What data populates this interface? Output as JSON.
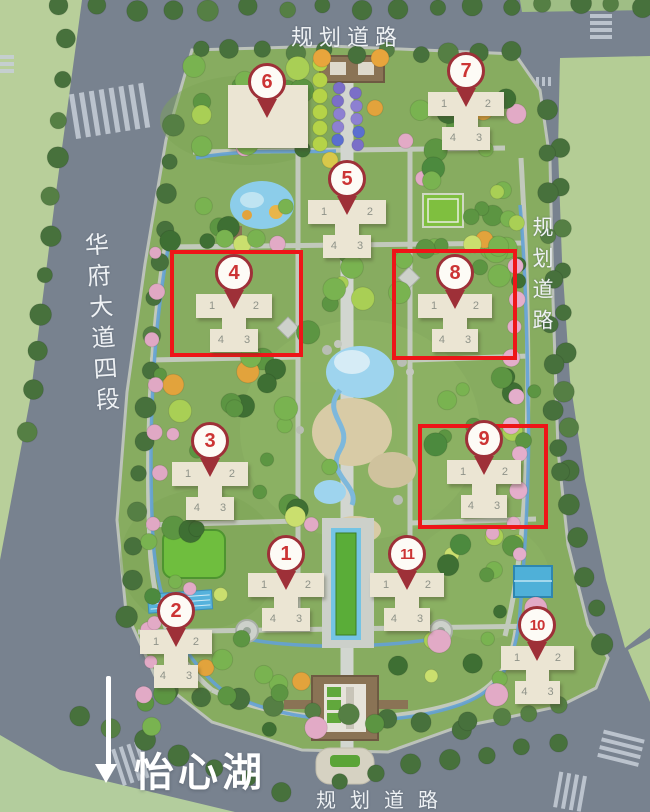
{
  "map": {
    "road_labels": {
      "top": "规划道路",
      "right": "规划道路",
      "bottom": "规划道路",
      "left": "华府大道四段"
    },
    "lake_label": "怡心湖",
    "buildings": [
      {
        "id": "1",
        "pin_label": "1",
        "type": "cross",
        "x": 248,
        "y": 573,
        "w": 76,
        "units": [
          "1",
          "2",
          "4",
          "3"
        ],
        "pin_x": 286,
        "pin_y": 589,
        "highlighted": false
      },
      {
        "id": "2",
        "pin_label": "2",
        "type": "cross",
        "x": 140,
        "y": 630,
        "w": 72,
        "units": [
          "1",
          "2",
          "4",
          "3"
        ],
        "pin_x": 176,
        "pin_y": 646,
        "highlighted": false
      },
      {
        "id": "3",
        "pin_label": "3",
        "type": "cross",
        "x": 172,
        "y": 462,
        "w": 76,
        "units": [
          "1",
          "2",
          "4",
          "3"
        ],
        "pin_x": 210,
        "pin_y": 476,
        "highlighted": false
      },
      {
        "id": "4",
        "pin_label": "4",
        "type": "cross",
        "x": 196,
        "y": 294,
        "w": 76,
        "units": [
          "1",
          "2",
          "4",
          "3"
        ],
        "pin_x": 234,
        "pin_y": 308,
        "highlighted": true
      },
      {
        "id": "5",
        "pin_label": "5",
        "type": "cross",
        "x": 308,
        "y": 200,
        "w": 78,
        "units": [
          "1",
          "2",
          "4",
          "3"
        ],
        "pin_x": 347,
        "pin_y": 214,
        "highlighted": false
      },
      {
        "id": "6",
        "pin_label": "6",
        "type": "block",
        "x": 228,
        "y": 85,
        "w": 80,
        "h": 63,
        "units": [],
        "pin_x": 267,
        "pin_y": 117,
        "highlighted": false
      },
      {
        "id": "7",
        "pin_label": "7",
        "type": "cross",
        "x": 428,
        "y": 92,
        "w": 76,
        "units": [
          "1",
          "2",
          "4",
          "3"
        ],
        "pin_x": 466,
        "pin_y": 106,
        "highlighted": false
      },
      {
        "id": "8",
        "pin_label": "8",
        "type": "cross",
        "x": 418,
        "y": 294,
        "w": 74,
        "units": [
          "1",
          "2",
          "4",
          "3"
        ],
        "pin_x": 455,
        "pin_y": 308,
        "highlighted": true
      },
      {
        "id": "9",
        "pin_label": "9",
        "type": "cross",
        "x": 447,
        "y": 460,
        "w": 74,
        "units": [
          "1",
          "2",
          "4",
          "3"
        ],
        "pin_x": 484,
        "pin_y": 474,
        "highlighted": true
      },
      {
        "id": "10",
        "pin_label": "10",
        "type": "cross",
        "x": 501,
        "y": 646,
        "w": 73,
        "units": [
          "1",
          "2",
          "4",
          "3"
        ],
        "pin_x": 537,
        "pin_y": 660,
        "highlighted": false
      },
      {
        "id": "11",
        "pin_label": "11",
        "type": "cross",
        "x": 370,
        "y": 573,
        "w": 74,
        "units": [
          "1",
          "2",
          "4",
          "3"
        ],
        "pin_x": 407,
        "pin_y": 589,
        "highlighted": false
      }
    ],
    "highlight_boxes": [
      {
        "building": "4",
        "x": 170,
        "y": 250,
        "w": 133,
        "h": 107
      },
      {
        "building": "8",
        "x": 392,
        "y": 249,
        "w": 125,
        "h": 111
      },
      {
        "building": "9",
        "x": 418,
        "y": 424,
        "w": 130,
        "h": 105
      }
    ],
    "colors": {
      "highlight_red": "#ee1518",
      "pin_border_red": "#9e3038",
      "pin_number_red": "#cc3434",
      "building_cream": "#ebe5d3",
      "road_gray": "#78828f",
      "site_green": "#87ac60",
      "label_white": "#eef1f4",
      "water_blue": "#74c4e4"
    }
  }
}
